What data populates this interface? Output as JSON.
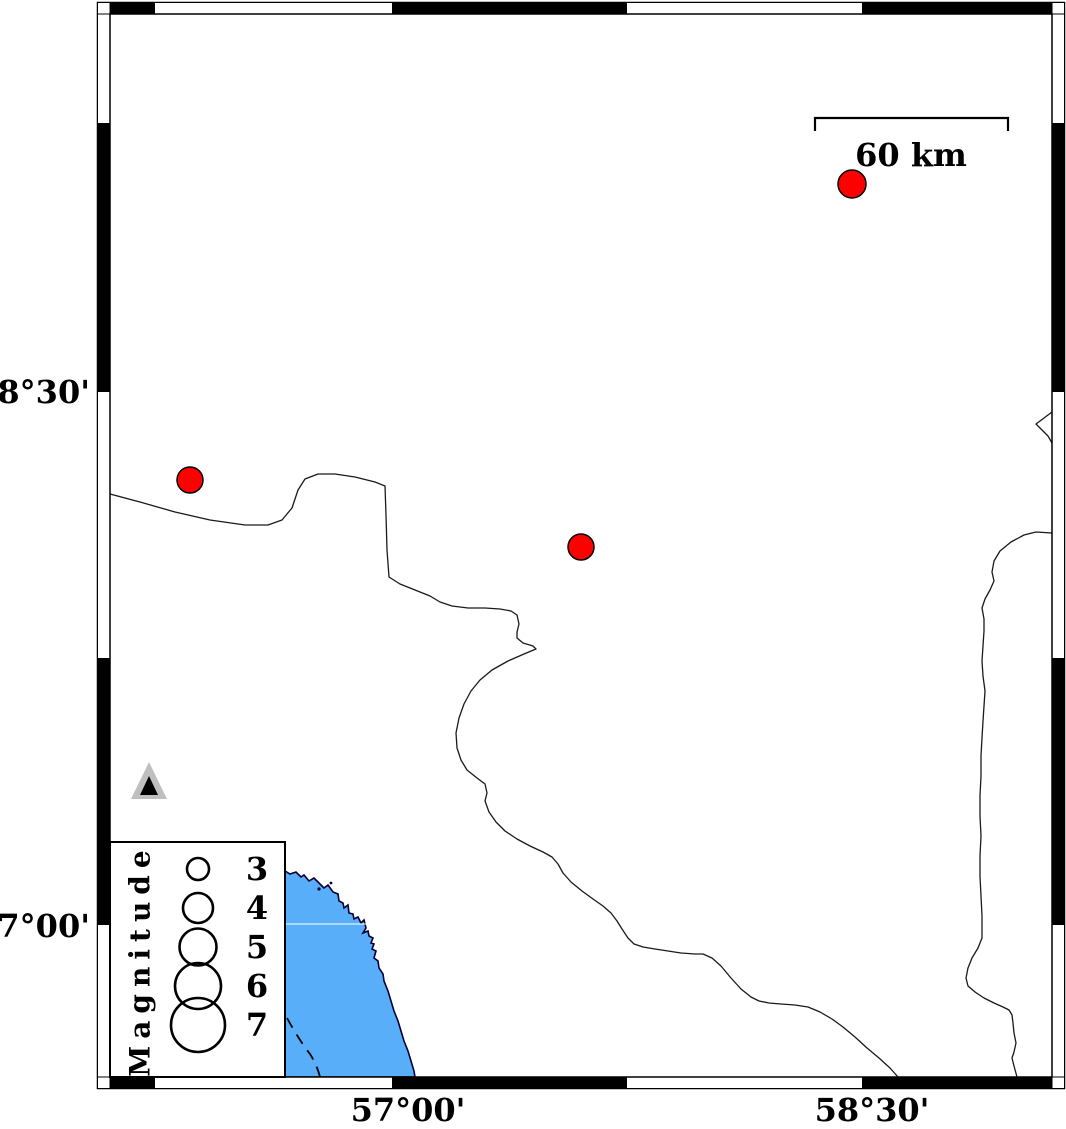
{
  "figure": {
    "type": "seismicity-map",
    "background": "#ffffff"
  },
  "axis": {
    "lat_labels": [
      "28°30'",
      "27°00'"
    ],
    "lon_labels": [
      "57°00'",
      "58°30'"
    ]
  },
  "scale_bar": {
    "label": "60 km"
  },
  "legend": {
    "title": "Magnitude",
    "entries": [
      {
        "label": "3",
        "radius": 11
      },
      {
        "label": "4",
        "radius": 15
      },
      {
        "label": "5",
        "radius": 18.5
      },
      {
        "label": "6",
        "radius": 23
      },
      {
        "label": "7",
        "radius": 27
      }
    ]
  },
  "map_data": {
    "earthquakes": [
      {
        "x": 852,
        "y": 184,
        "r": 14
      },
      {
        "x": 190,
        "y": 480,
        "r": 13
      },
      {
        "x": 581,
        "y": 547,
        "r": 13
      }
    ],
    "stations": [
      {
        "x": 149,
        "y": 785
      }
    ],
    "colors": {
      "earthquake_fill": "#ff0000",
      "water_fill": "#58AEF8",
      "coast_stroke": "#000033",
      "boundary_stroke": "#1a1a1a",
      "station_fill": "#000000",
      "station_outline": "#bfbfbf",
      "frame_fill": "#000000"
    }
  }
}
